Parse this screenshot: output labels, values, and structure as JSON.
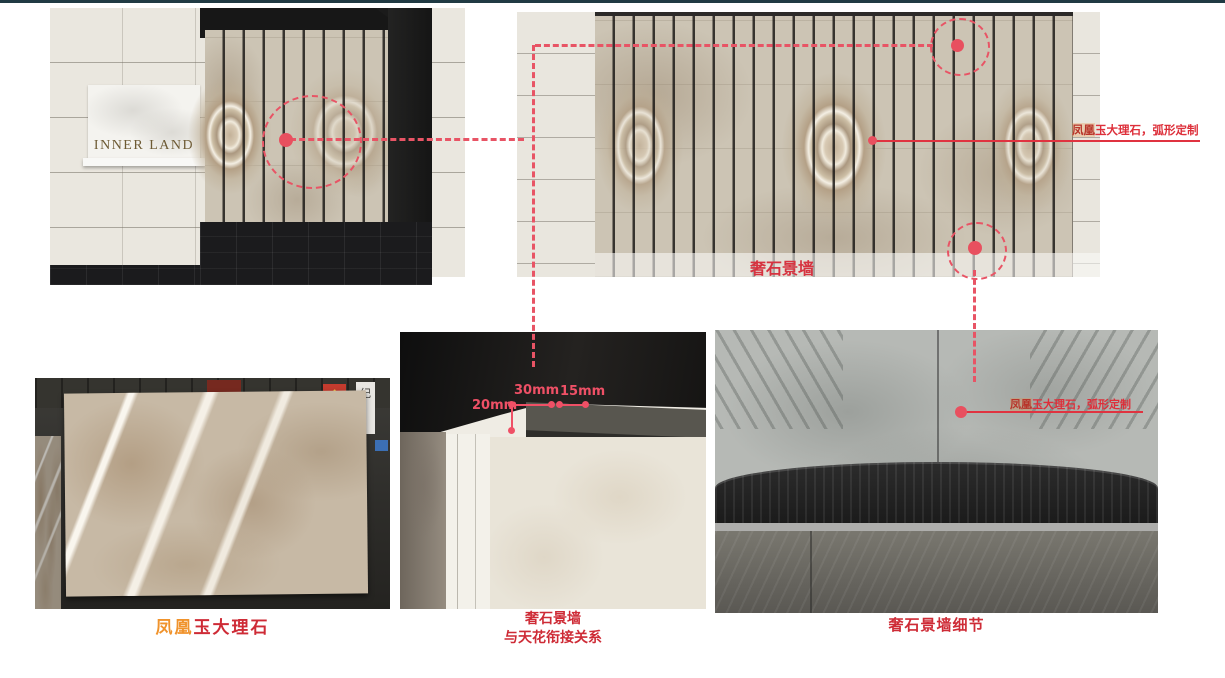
{
  "slide": {
    "top_bar_color": "#203a43",
    "background": "#ffffff"
  },
  "colors": {
    "annotation_pink": "#e85465",
    "annotation_red": "#dd2f3a",
    "caption_red": "#ce2b36",
    "dimension_pink": "#ef5066",
    "wall_label_red": "#d63340",
    "highlight_orange": "#f0932c",
    "sign_gold": "#6d5a33"
  },
  "top_left_render": {
    "sign_text": "INNER LAND"
  },
  "top_right_elevation": {
    "wall_label": "奢石景墙",
    "annotation_prefix": "凤凰",
    "annotation_rest": "玉大理石，弧形定制"
  },
  "bottom_left_photo": {
    "caption_prefix": "凤凰",
    "caption_rest": "玉大理石",
    "background_sign_gold": "金",
    "background_sign_banner": "纪"
  },
  "bottom_middle_detail": {
    "dim_side": "20mm",
    "dim_mid": "30mm",
    "dim_right": "15mm",
    "caption_line1": "奢石景墙",
    "caption_line2": "与天花衔接关系"
  },
  "bottom_right_detail": {
    "annotation_prefix": "凤凰",
    "annotation_rest": "玉大理石，弧形定制",
    "caption": "奢石景墙细节"
  }
}
